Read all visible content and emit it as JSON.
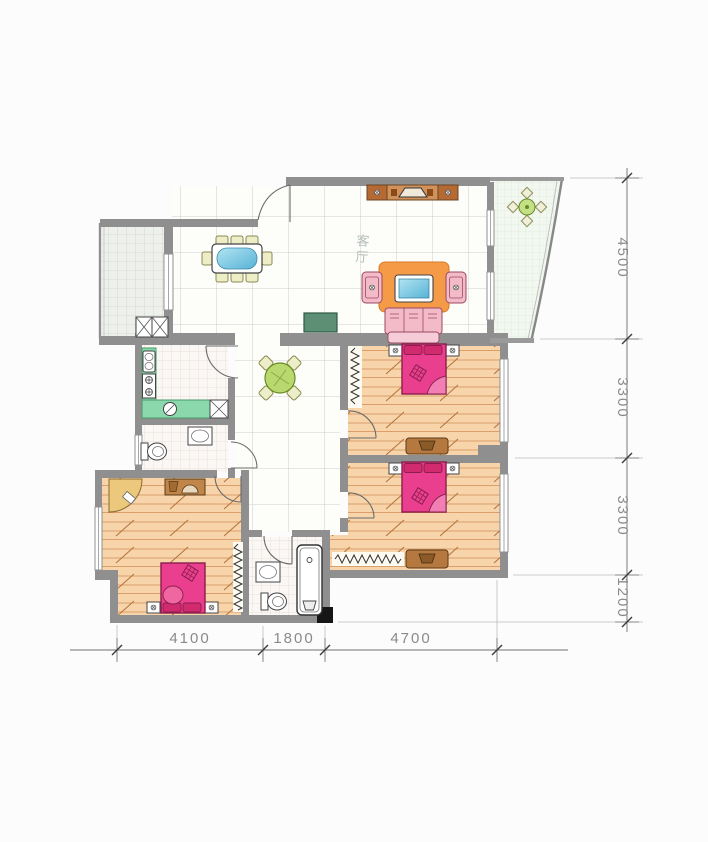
{
  "plan": {
    "room_label": "客厅",
    "dimensions": {
      "right": [
        "4500",
        "3300",
        "3300",
        "1200"
      ],
      "bottom": [
        "4100",
        "1800",
        "4700"
      ]
    },
    "colors": {
      "wall": "#8f8f8f",
      "wood_floor": "#f7d4a9",
      "wood_line": "#cf8c55",
      "bed": "#ea3f8e",
      "bed_dark": "#c2185b",
      "sofa_orange": "#f59b48",
      "armchair_pink": "#f3bac8",
      "kitchen_counter": "#8ad8ac",
      "table_blue": "#7cc8e4",
      "round_table_green": "#b9d96e",
      "entry_cabinet_green": "#5c8f74",
      "dresser_brown": "#b5793f",
      "tv_cabinet": "#d0915a",
      "dimension_text": "#8a8a8a"
    }
  }
}
